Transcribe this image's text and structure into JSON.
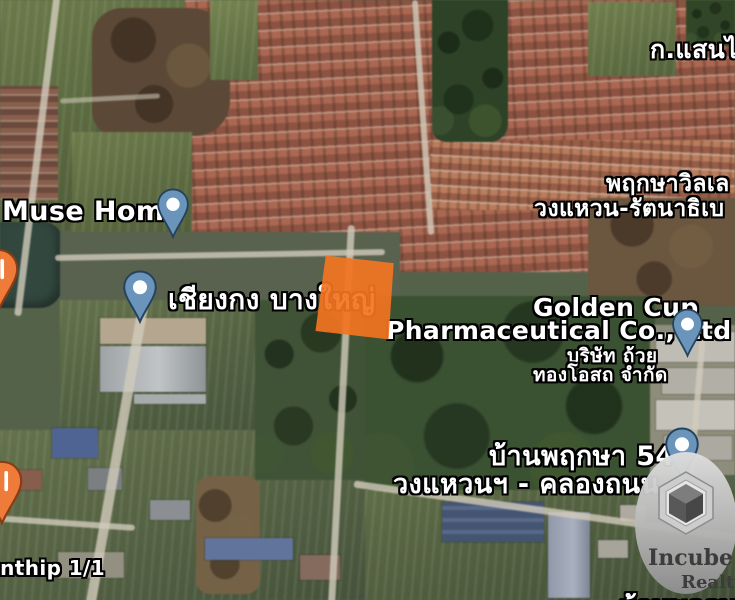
{
  "labels": {
    "top_right": "ก.แสนไ",
    "muse_home": "Muse Home",
    "chiang_kong": "เชียงกง บางใหญ่",
    "pruksa_village_line1": "พฤกษาวิลเล",
    "pruksa_village_line2": "วงแหวน-รัตนาธิเบ",
    "golden_cup_line1": "Golden Cup",
    "golden_cup_line2": "Pharmaceutical Co., Ltd",
    "golden_cup_thai_line1": "บริษัท ถ้วย",
    "golden_cup_thai_line2": "ทองโอสถ จำกัด",
    "baan_pruksa54": "บ้านพฤกษา 54",
    "baan_pruksa54_sub": "วงแหวนฯ - คลองถนน",
    "bottom_left_partial": "onthip 1/1",
    "bottom_right_partial": "บ้านพฤกษา"
  },
  "watermark": {
    "brand_line1": "Incube",
    "brand_line2": "Realty"
  },
  "plot": {
    "highlight_color": "#f37421"
  },
  "pins": {
    "place_pin_color": "#6b94ba",
    "food_pin_color": "#ef7b3a"
  }
}
